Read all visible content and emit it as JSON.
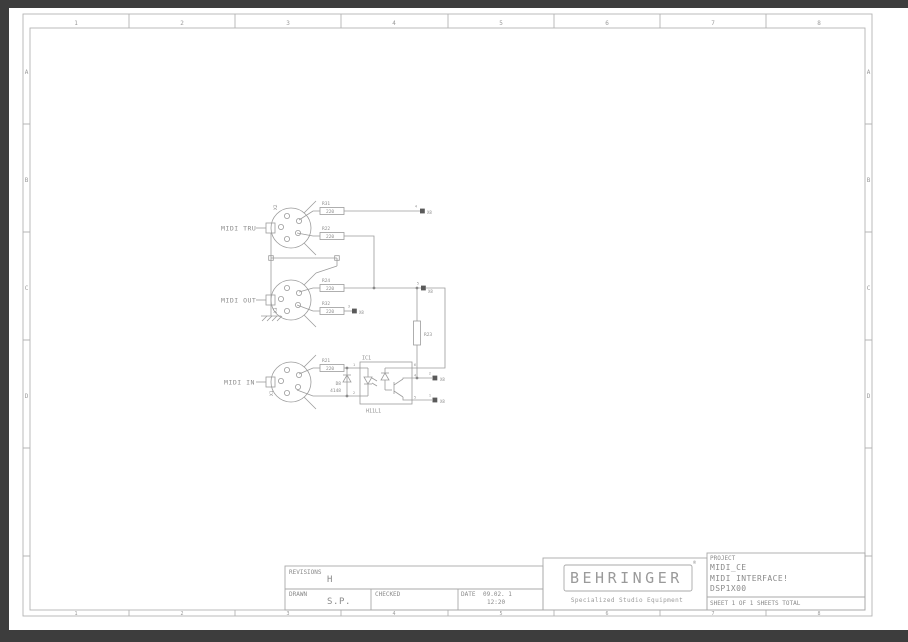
{
  "colors": {
    "page_bg": "#ffffff",
    "border_bar": "#3d3d3d",
    "line_ink": "#9b9b9b",
    "text_ink": "#8a8a8a"
  },
  "page": {
    "grid": {
      "columns": [
        "1",
        "2",
        "3",
        "4",
        "5",
        "6",
        "7",
        "8"
      ],
      "rows": [
        "A",
        "B",
        "C",
        "D"
      ]
    }
  },
  "schematic": {
    "connectors": [
      {
        "ref": "X2",
        "label": "MIDI TRU"
      },
      {
        "ref": "X3",
        "label": "MIDI OUT"
      },
      {
        "ref": "X1",
        "label": "MIDI IN"
      }
    ],
    "resistors": [
      {
        "ref": "R31",
        "value": "220"
      },
      {
        "ref": "R22",
        "value": "220"
      },
      {
        "ref": "R24",
        "value": "220"
      },
      {
        "ref": "R32",
        "value": "220"
      },
      {
        "ref": "R21",
        "value": "220"
      }
    ],
    "pullup": {
      "ref": "R23"
    },
    "diode": {
      "ref": "D8",
      "value": "4148"
    },
    "ic": {
      "ref": "IC1",
      "part": "H11L1",
      "pins": [
        "1",
        "2",
        "6",
        "4",
        "5"
      ]
    },
    "net_flags": [
      {
        "pin": "4",
        "net": "X8"
      },
      {
        "pin": "5",
        "net": "X8"
      },
      {
        "pin": "3",
        "net": "X8"
      },
      {
        "pin": "2",
        "net": "X8"
      },
      {
        "pin": "1",
        "net": "X8"
      }
    ]
  },
  "title_block": {
    "revisions_label": "REVISIONS",
    "revision": "H",
    "drawn_label": "DRAWN",
    "drawn_by": "S.P.",
    "checked_label": "CHECKED",
    "checked_by": "",
    "date_label": "DATE",
    "date": "09.02. 1",
    "time": "12:20",
    "brand": {
      "name": "BEHRINGER",
      "mark": "®",
      "tagline": "Specialized Studio Equipment"
    },
    "project_label": "PROJECT",
    "project_name": "MIDI_CE",
    "project_desc": "MIDI INTERFACE!",
    "project_model": "DSP1X00",
    "sheet_info": "SHEET 1  OF 1  SHEETS TOTAL"
  }
}
